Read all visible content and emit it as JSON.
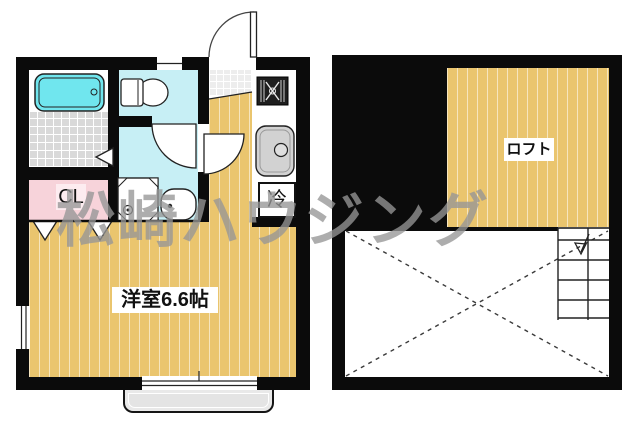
{
  "watermark": {
    "text": "松崎ハウジング"
  },
  "plans": {
    "left": {
      "name": "main-floor-plan",
      "labels": {
        "main_room": "洋室6.6帖",
        "closet": "CL",
        "refrigerator": "冷"
      },
      "fixtures": [
        "bathtub",
        "toilet",
        "washing-machine",
        "wash-basin",
        "gas-stove",
        "kitchen-sink",
        "entrance-door",
        "windows",
        "balcony"
      ]
    },
    "right": {
      "name": "loft-floor-plan",
      "labels": {
        "loft": "ロフト"
      },
      "fixtures": [
        "ladder",
        "void-cross",
        "down-arrow"
      ]
    }
  },
  "colors": {
    "wall": "#0b0b0b",
    "wood_floor": "#eac56e",
    "wet_area_floor": "#c7eff5",
    "bathtub": "#70e6ee",
    "bath_tile": "#d9d9d9",
    "closet_floor": "#f7d3da",
    "fixture_gray": "#d2d2d2",
    "balcony": "#e9e9e9",
    "watermark": "#969696"
  }
}
